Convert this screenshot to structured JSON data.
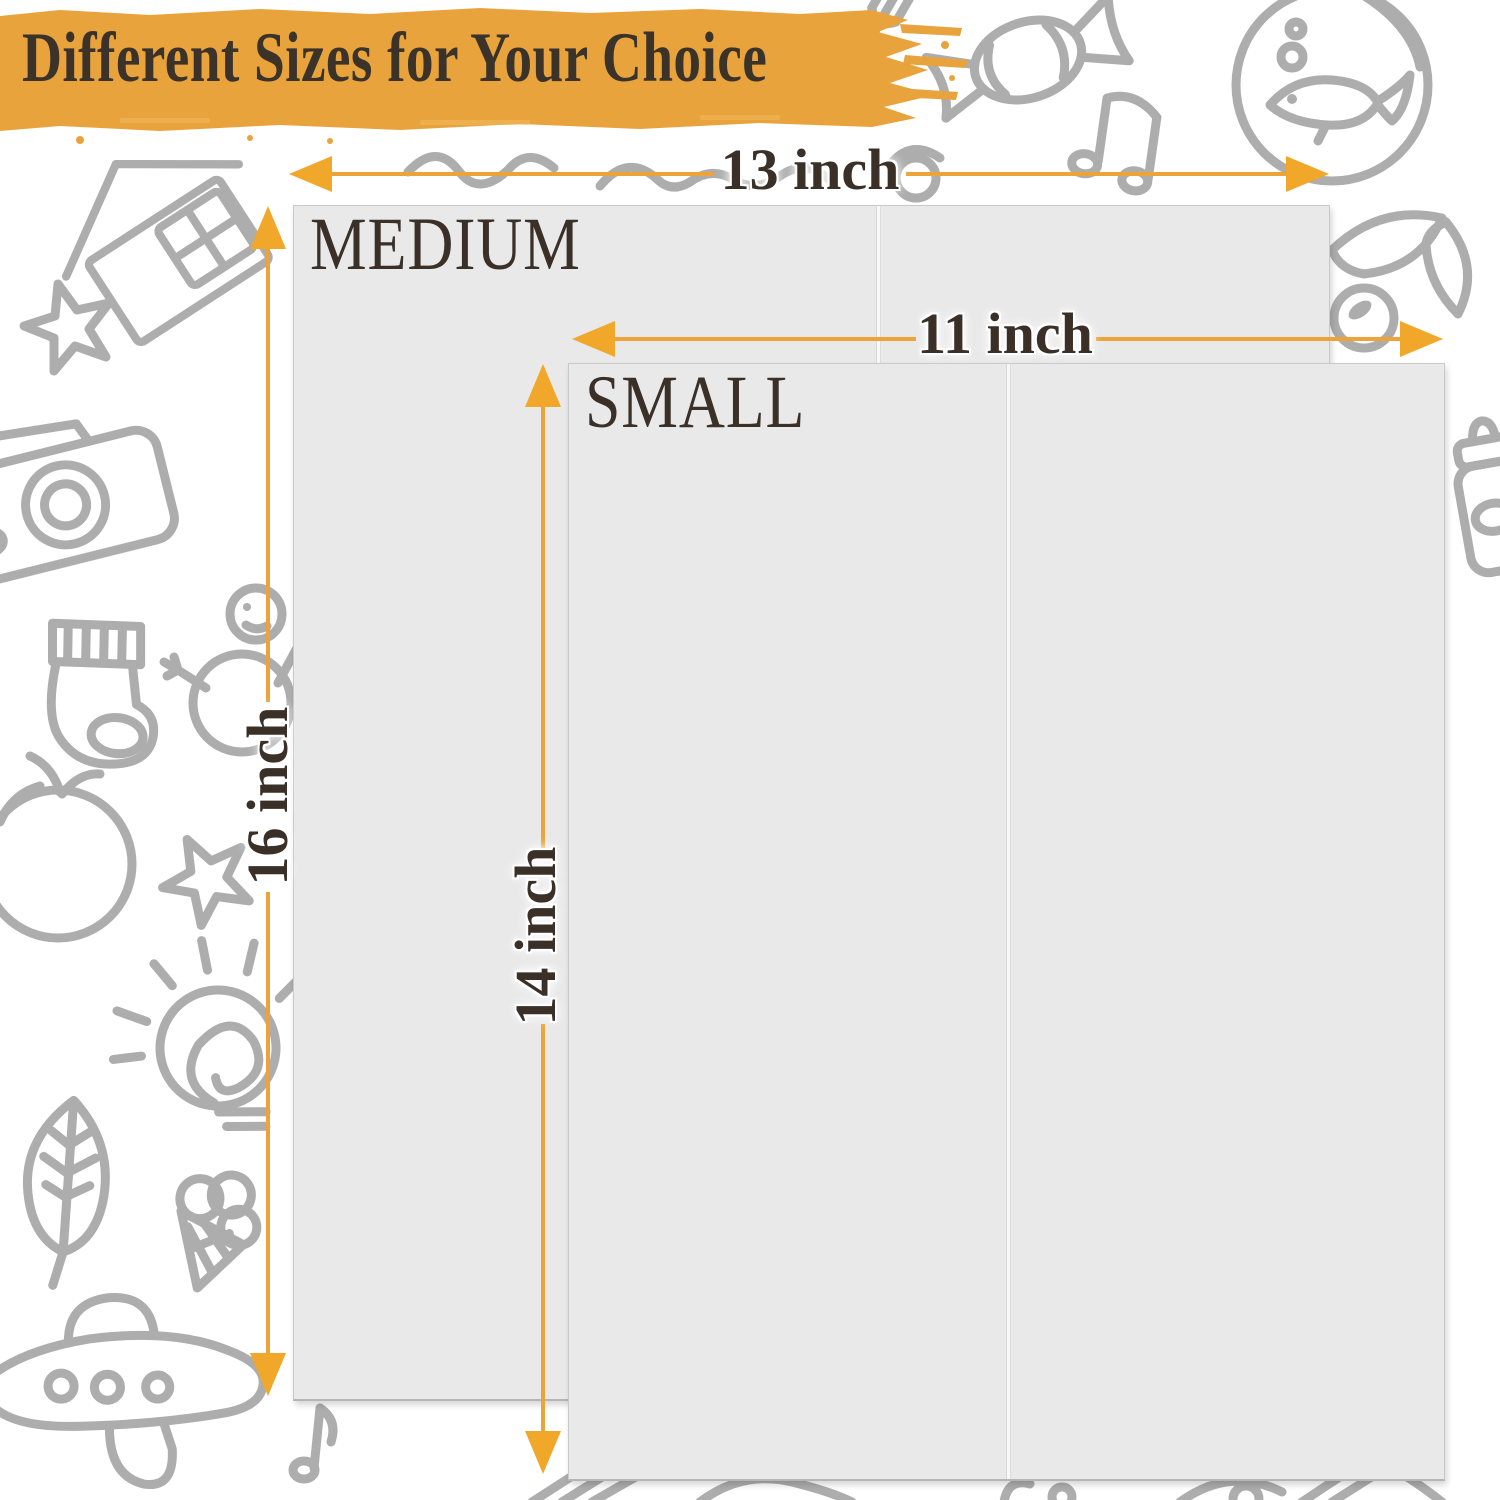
{
  "header": {
    "title": "Different Sizes for Your Choice"
  },
  "products": {
    "medium": {
      "label": "MEDIUM",
      "width": "13 inch",
      "height": "16 inch"
    },
    "small": {
      "label": "SMALL",
      "width": "11 inch",
      "height": "14 inch"
    }
  },
  "colors": {
    "brush_orange": "#E8A33C",
    "arrow_orange": "#F1A729",
    "text_brown": "#3A3027",
    "panel_gray": "#E9E9E9",
    "doodle_gray": "#ADADAD"
  },
  "background": {
    "doodles": [
      "house-icon",
      "star-icon",
      "camera-icon",
      "sock-icon",
      "snowman-icon",
      "apple-icon",
      "light-bulb-icon",
      "leaf-icon",
      "ice-cream-icon",
      "airplane-icon",
      "music-note-icon",
      "fish-bowl-icon",
      "music-notes-icon",
      "candy-icon",
      "fork-icon",
      "squiggle-icon",
      "cherry-leaves-icon",
      "baby-bottle-icon",
      "shoe-icons"
    ]
  }
}
